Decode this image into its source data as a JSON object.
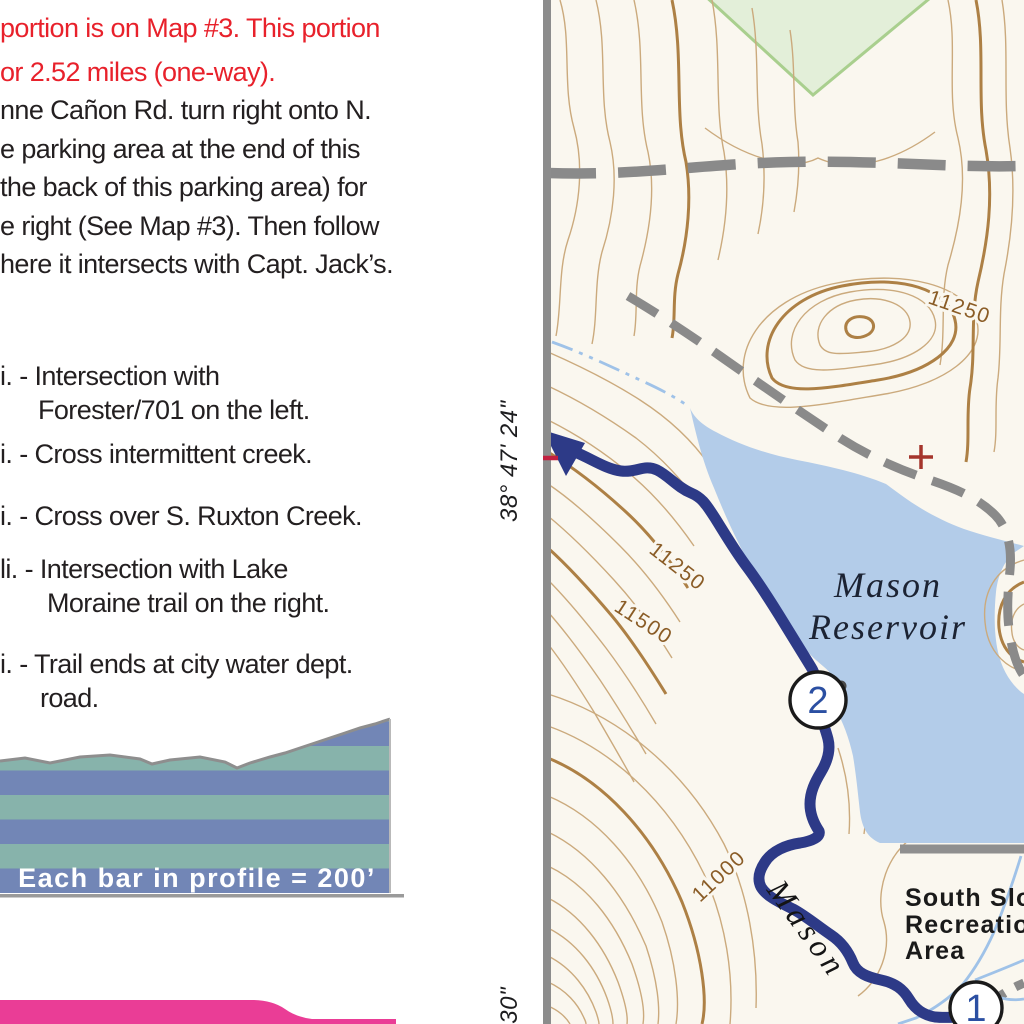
{
  "left_panel": {
    "intro_red": [
      "portion is on Map #3. This portion",
      "or 2.52 miles (one-way)."
    ],
    "directions": [
      "nne Cañon Rd. turn right onto N.",
      "e parking area at the end of this",
      "the back of this parking area) for",
      "e right (See Map #3). Then follow",
      "here it intersects with Capt. Jack’s."
    ],
    "waypoint_lines": [
      "i. - Intersection with",
      "Forester/701 on the left.",
      "i. - Cross intermittent creek.",
      "i. - Cross over S. Ruxton Creek.",
      "li. - Intersection with Lake",
      "Moraine trail on the right.",
      "i. - Trail ends at city water dept.",
      "road."
    ],
    "profile_caption": "Each bar in profile = 200’"
  },
  "map": {
    "water_label": {
      "line1": "Mason",
      "line2": "Reservoir"
    },
    "trail_label": "Mason",
    "area_label": [
      "South Slo",
      "Recreatio",
      "Area"
    ],
    "contour_labels": {
      "ne": "11250",
      "west_upper": "11250",
      "west_lower": "11500",
      "south": "11000"
    },
    "latitude_labels": {
      "upper": "38° 47' 24\"",
      "lower": "' 30\""
    },
    "markers": {
      "m1": "1",
      "m2": "2"
    }
  },
  "colors": {
    "red_text": "#e8212b",
    "black_text": "#231f20",
    "profile_blue": "#7286b6",
    "profile_teal": "#87b3ab",
    "pink_band": "#ea3d96",
    "map_background": "#faf7ef",
    "water": "#b3cce9",
    "trail": "#2d3a87",
    "contour_thin": "#cbaa7d",
    "contour_index": "#ad8045",
    "road_gray": "#8a8a8a",
    "green_area": "#e3efd9",
    "stream_blue": "#9fc2e8",
    "marker_number_blue": "#2b4fa2",
    "label_brown": "#8a5c26",
    "latitude_tick_red": "#c22040",
    "survey_cross_red": "#a5352c"
  }
}
